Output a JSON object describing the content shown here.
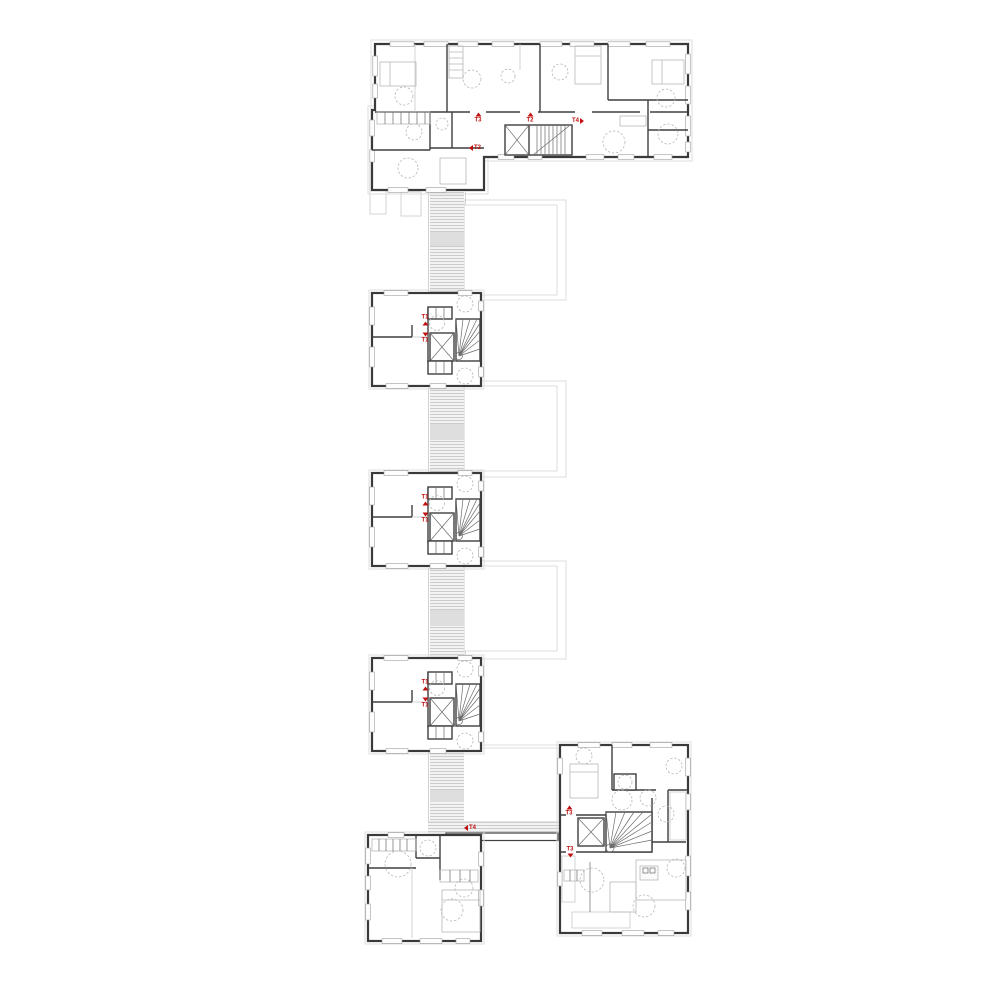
{
  "page": {
    "background": "#ffffff",
    "width": 1000,
    "height": 1000
  },
  "plan": {
    "colors": {
      "accent_red": "#c01010",
      "wall": "#3a3a3a",
      "hatch_line": "#bdbdbd",
      "stipple_dot": "#9a9a9a",
      "light_fill": "#f3f3f3",
      "light_outline": "#dedede"
    },
    "labels": [
      {
        "id": "top-t3",
        "text": "T3",
        "arrow": "up",
        "layout": "col-arrow-first",
        "x": 478,
        "y": 118
      },
      {
        "id": "top-t2",
        "text": "T2",
        "arrow": "up",
        "layout": "col-arrow-first",
        "x": 530,
        "y": 118
      },
      {
        "id": "top-t4",
        "text": "T4",
        "arrow": "right",
        "layout": "row-text-first",
        "x": 578,
        "y": 121
      },
      {
        "id": "top-entry-t2",
        "text": "T2",
        "arrow": "left",
        "layout": "row-arrow-first",
        "x": 475,
        "y": 148
      },
      {
        "id": "unit1-t1-up",
        "text": "T1",
        "arrow": "up",
        "layout": "col-text-first",
        "x": 425,
        "y": 320
      },
      {
        "id": "unit1-t1-down",
        "text": "T1",
        "arrow": "down",
        "layout": "col-arrow-first",
        "x": 425,
        "y": 338
      },
      {
        "id": "unit2-t1-up",
        "text": "T1",
        "arrow": "up",
        "layout": "col-text-first",
        "x": 425,
        "y": 500
      },
      {
        "id": "unit2-t1-down",
        "text": "T1",
        "arrow": "down",
        "layout": "col-arrow-first",
        "x": 425,
        "y": 518
      },
      {
        "id": "unit3-t1-up",
        "text": "T1",
        "arrow": "up",
        "layout": "col-text-first",
        "x": 425,
        "y": 685
      },
      {
        "id": "unit3-t1-down",
        "text": "T1",
        "arrow": "down",
        "layout": "col-arrow-first",
        "x": 425,
        "y": 703
      },
      {
        "id": "bottom-t3-up",
        "text": "T3",
        "arrow": "up",
        "layout": "col-arrow-first",
        "x": 569,
        "y": 811
      },
      {
        "id": "bottom-t3-down",
        "text": "T3",
        "arrow": "down",
        "layout": "col-text-first",
        "x": 570,
        "y": 852
      },
      {
        "id": "bottom-t4",
        "text": "T4",
        "arrow": "left",
        "layout": "row-arrow-first",
        "x": 470,
        "y": 828
      }
    ]
  }
}
